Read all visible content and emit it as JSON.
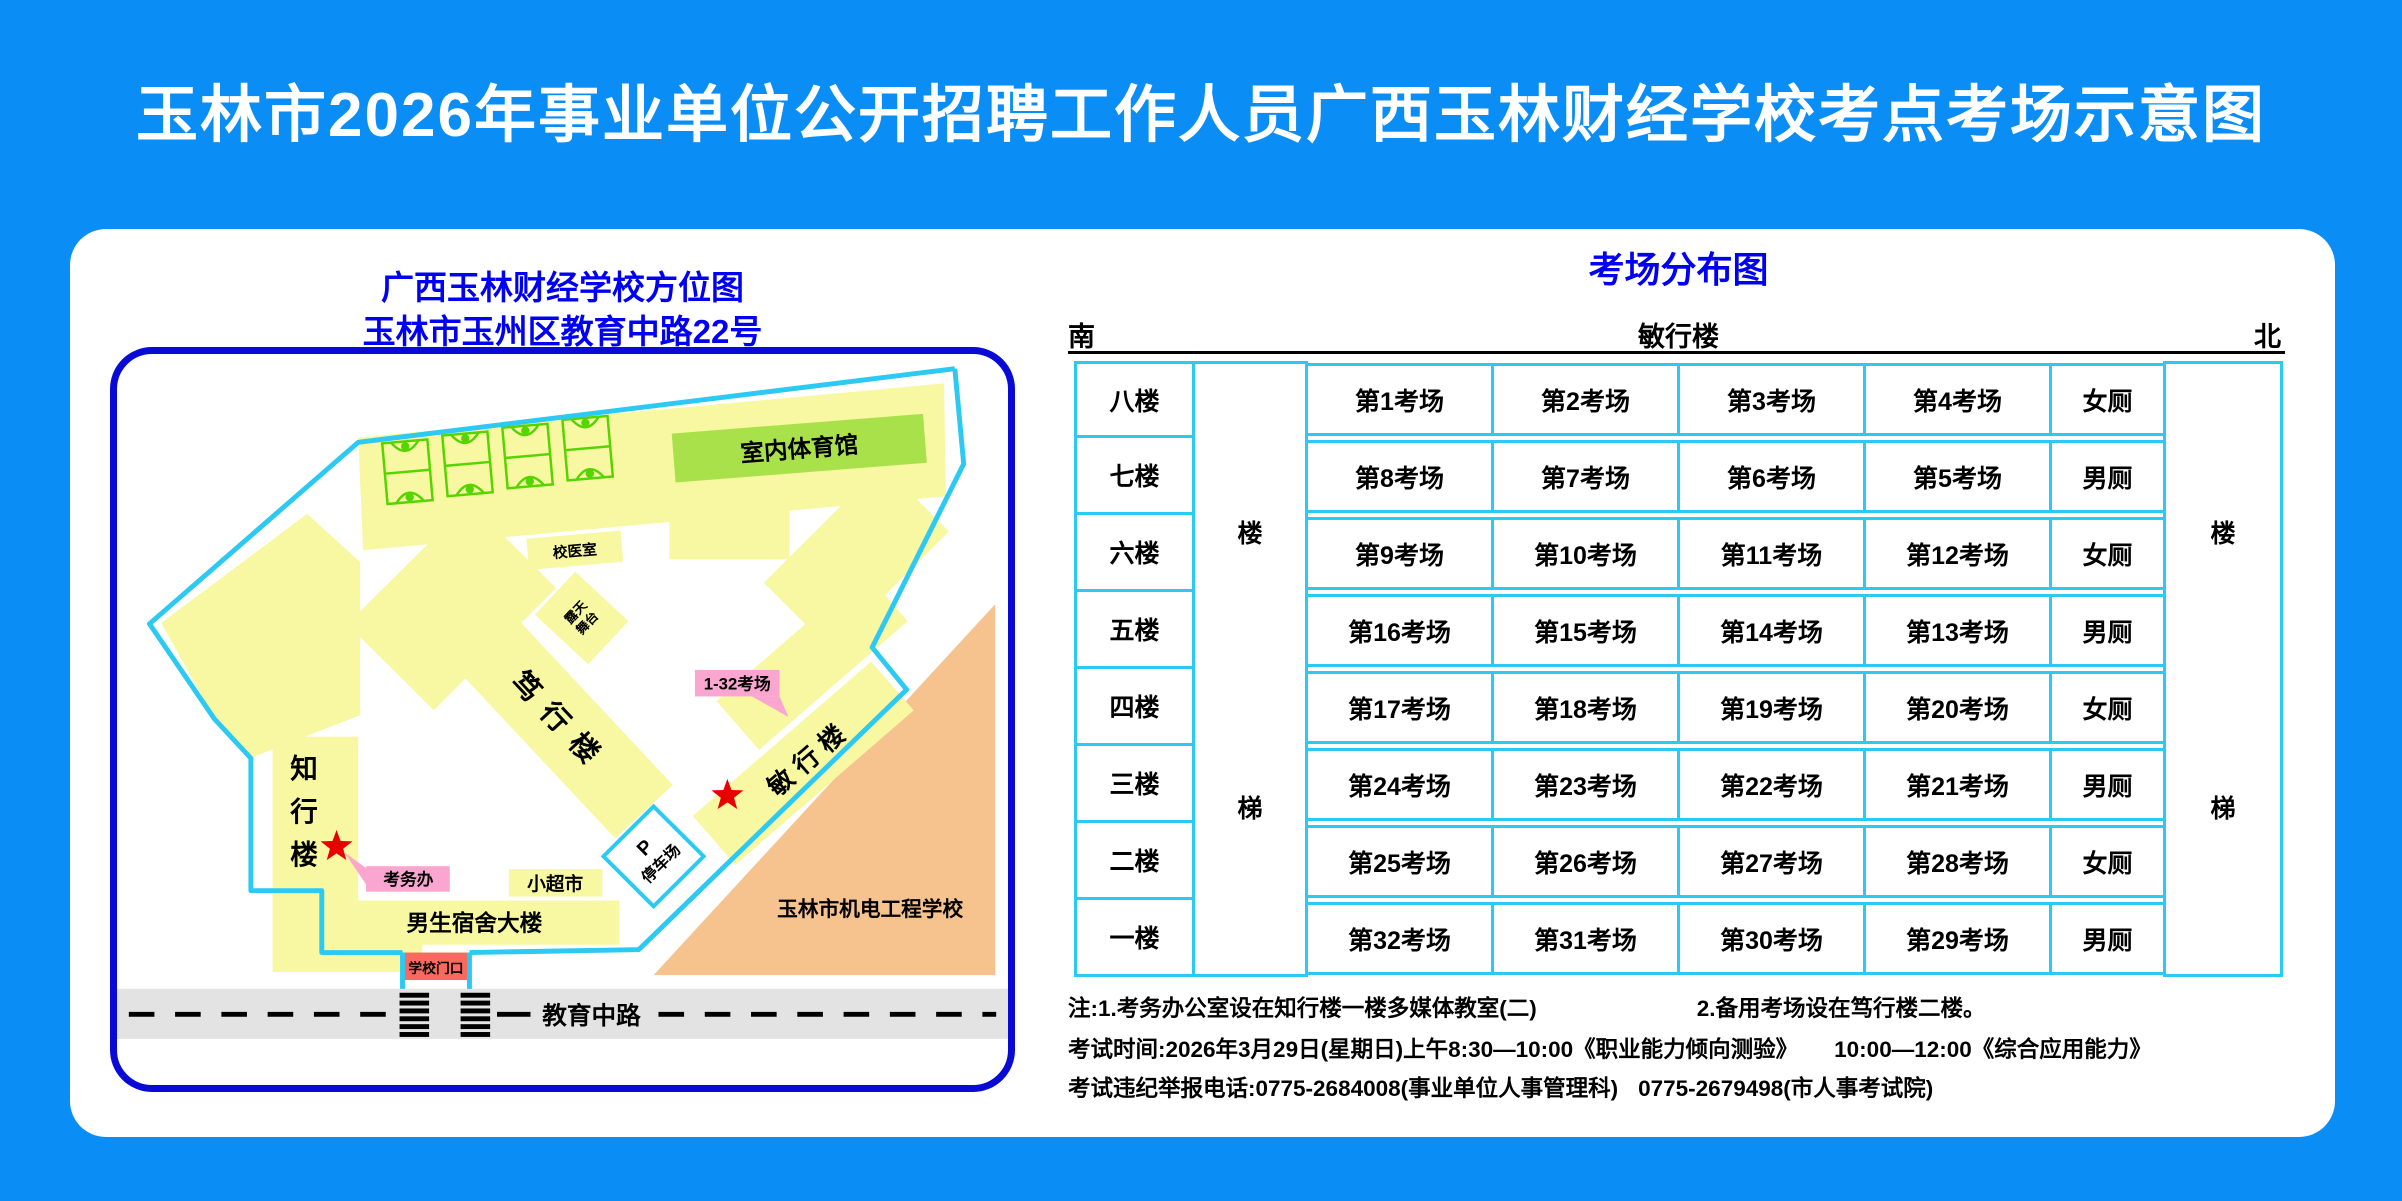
{
  "title": "玉林市2026年事业单位公开招聘工作人员广西玉林财经学校考点考场示意图",
  "map": {
    "title_line1": "广西玉林财经学校方位图",
    "title_line2": "玉林市玉州区教育中路22号",
    "labels": {
      "gym": "室内体育馆",
      "clinic": "校医室",
      "stage_l1": "露天",
      "stage_l2": "舞台",
      "duxing_building": "笃行楼",
      "minxing_building": "敏行楼",
      "zhixing1": "知",
      "zhixing2": "行",
      "zhixing3": "楼",
      "exam_office": "考务办",
      "rooms_callout": "1-32考场",
      "supermarket": "小超市",
      "dormitory": "男生宿舍大楼",
      "gate": "学校门口",
      "parking_p": "P",
      "parking": "停车场",
      "neighbor_school": "玉林市机电工程学校",
      "road": "教育中路"
    }
  },
  "distribution": {
    "title": "考场分布图",
    "south": "南",
    "building": "敏行楼",
    "north": "北",
    "stairs_top": "楼",
    "stairs_bottom": "梯",
    "rows": [
      {
        "floor": "八楼",
        "rooms": [
          "第1考场",
          "第2考场",
          "第3考场",
          "第4考场"
        ],
        "toilet": "女厕"
      },
      {
        "floor": "七楼",
        "rooms": [
          "第8考场",
          "第7考场",
          "第6考场",
          "第5考场"
        ],
        "toilet": "男厕"
      },
      {
        "floor": "六楼",
        "rooms": [
          "第9考场",
          "第10考场",
          "第11考场",
          "第12考场"
        ],
        "toilet": "女厕"
      },
      {
        "floor": "五楼",
        "rooms": [
          "第16考场",
          "第15考场",
          "第14考场",
          "第13考场"
        ],
        "toilet": "男厕"
      },
      {
        "floor": "四楼",
        "rooms": [
          "第17考场",
          "第18考场",
          "第19考场",
          "第20考场"
        ],
        "toilet": "女厕"
      },
      {
        "floor": "三楼",
        "rooms": [
          "第24考场",
          "第23考场",
          "第22考场",
          "第21考场"
        ],
        "toilet": "男厕"
      },
      {
        "floor": "二楼",
        "rooms": [
          "第25考场",
          "第26考场",
          "第27考场",
          "第28考场"
        ],
        "toilet": "女厕"
      },
      {
        "floor": "一楼",
        "rooms": [
          "第32考场",
          "第31考场",
          "第30考场",
          "第29考场"
        ],
        "toilet": "男厕"
      }
    ]
  },
  "notes": {
    "line1_a": "注:1.考务办公室设在知行楼一楼多媒体教室(二)",
    "line1_b": "2.备用考场设在笃行楼二楼。",
    "line2_a": "考试时间:2026年3月29日(星期日)上午8:30—10:00《职业能力倾向测验》",
    "line2_b": "10:00—12:00《综合应用能力》",
    "line3_a": "考试违纪举报电话:0775-2684008(事业单位人事管理科)",
    "line3_b": "0775-2679498(市人事考试院)"
  },
  "colors": {
    "background_blue": "#0a8ef5",
    "panel_white": "#ffffff",
    "heading_blue": "#0000f2",
    "map_border_navy": "#0a0ad6",
    "table_cyan": "#2cc9f2",
    "building_yellow": "#f8f8a2",
    "court_green": "#55d400",
    "gym_green": "#a9e14b",
    "neighbor_orange": "#f6c28e",
    "callout_pink": "#fba6d0",
    "star_red": "#e80000",
    "gate_red": "#f86a60",
    "road_gray": "#e3e3e3"
  }
}
